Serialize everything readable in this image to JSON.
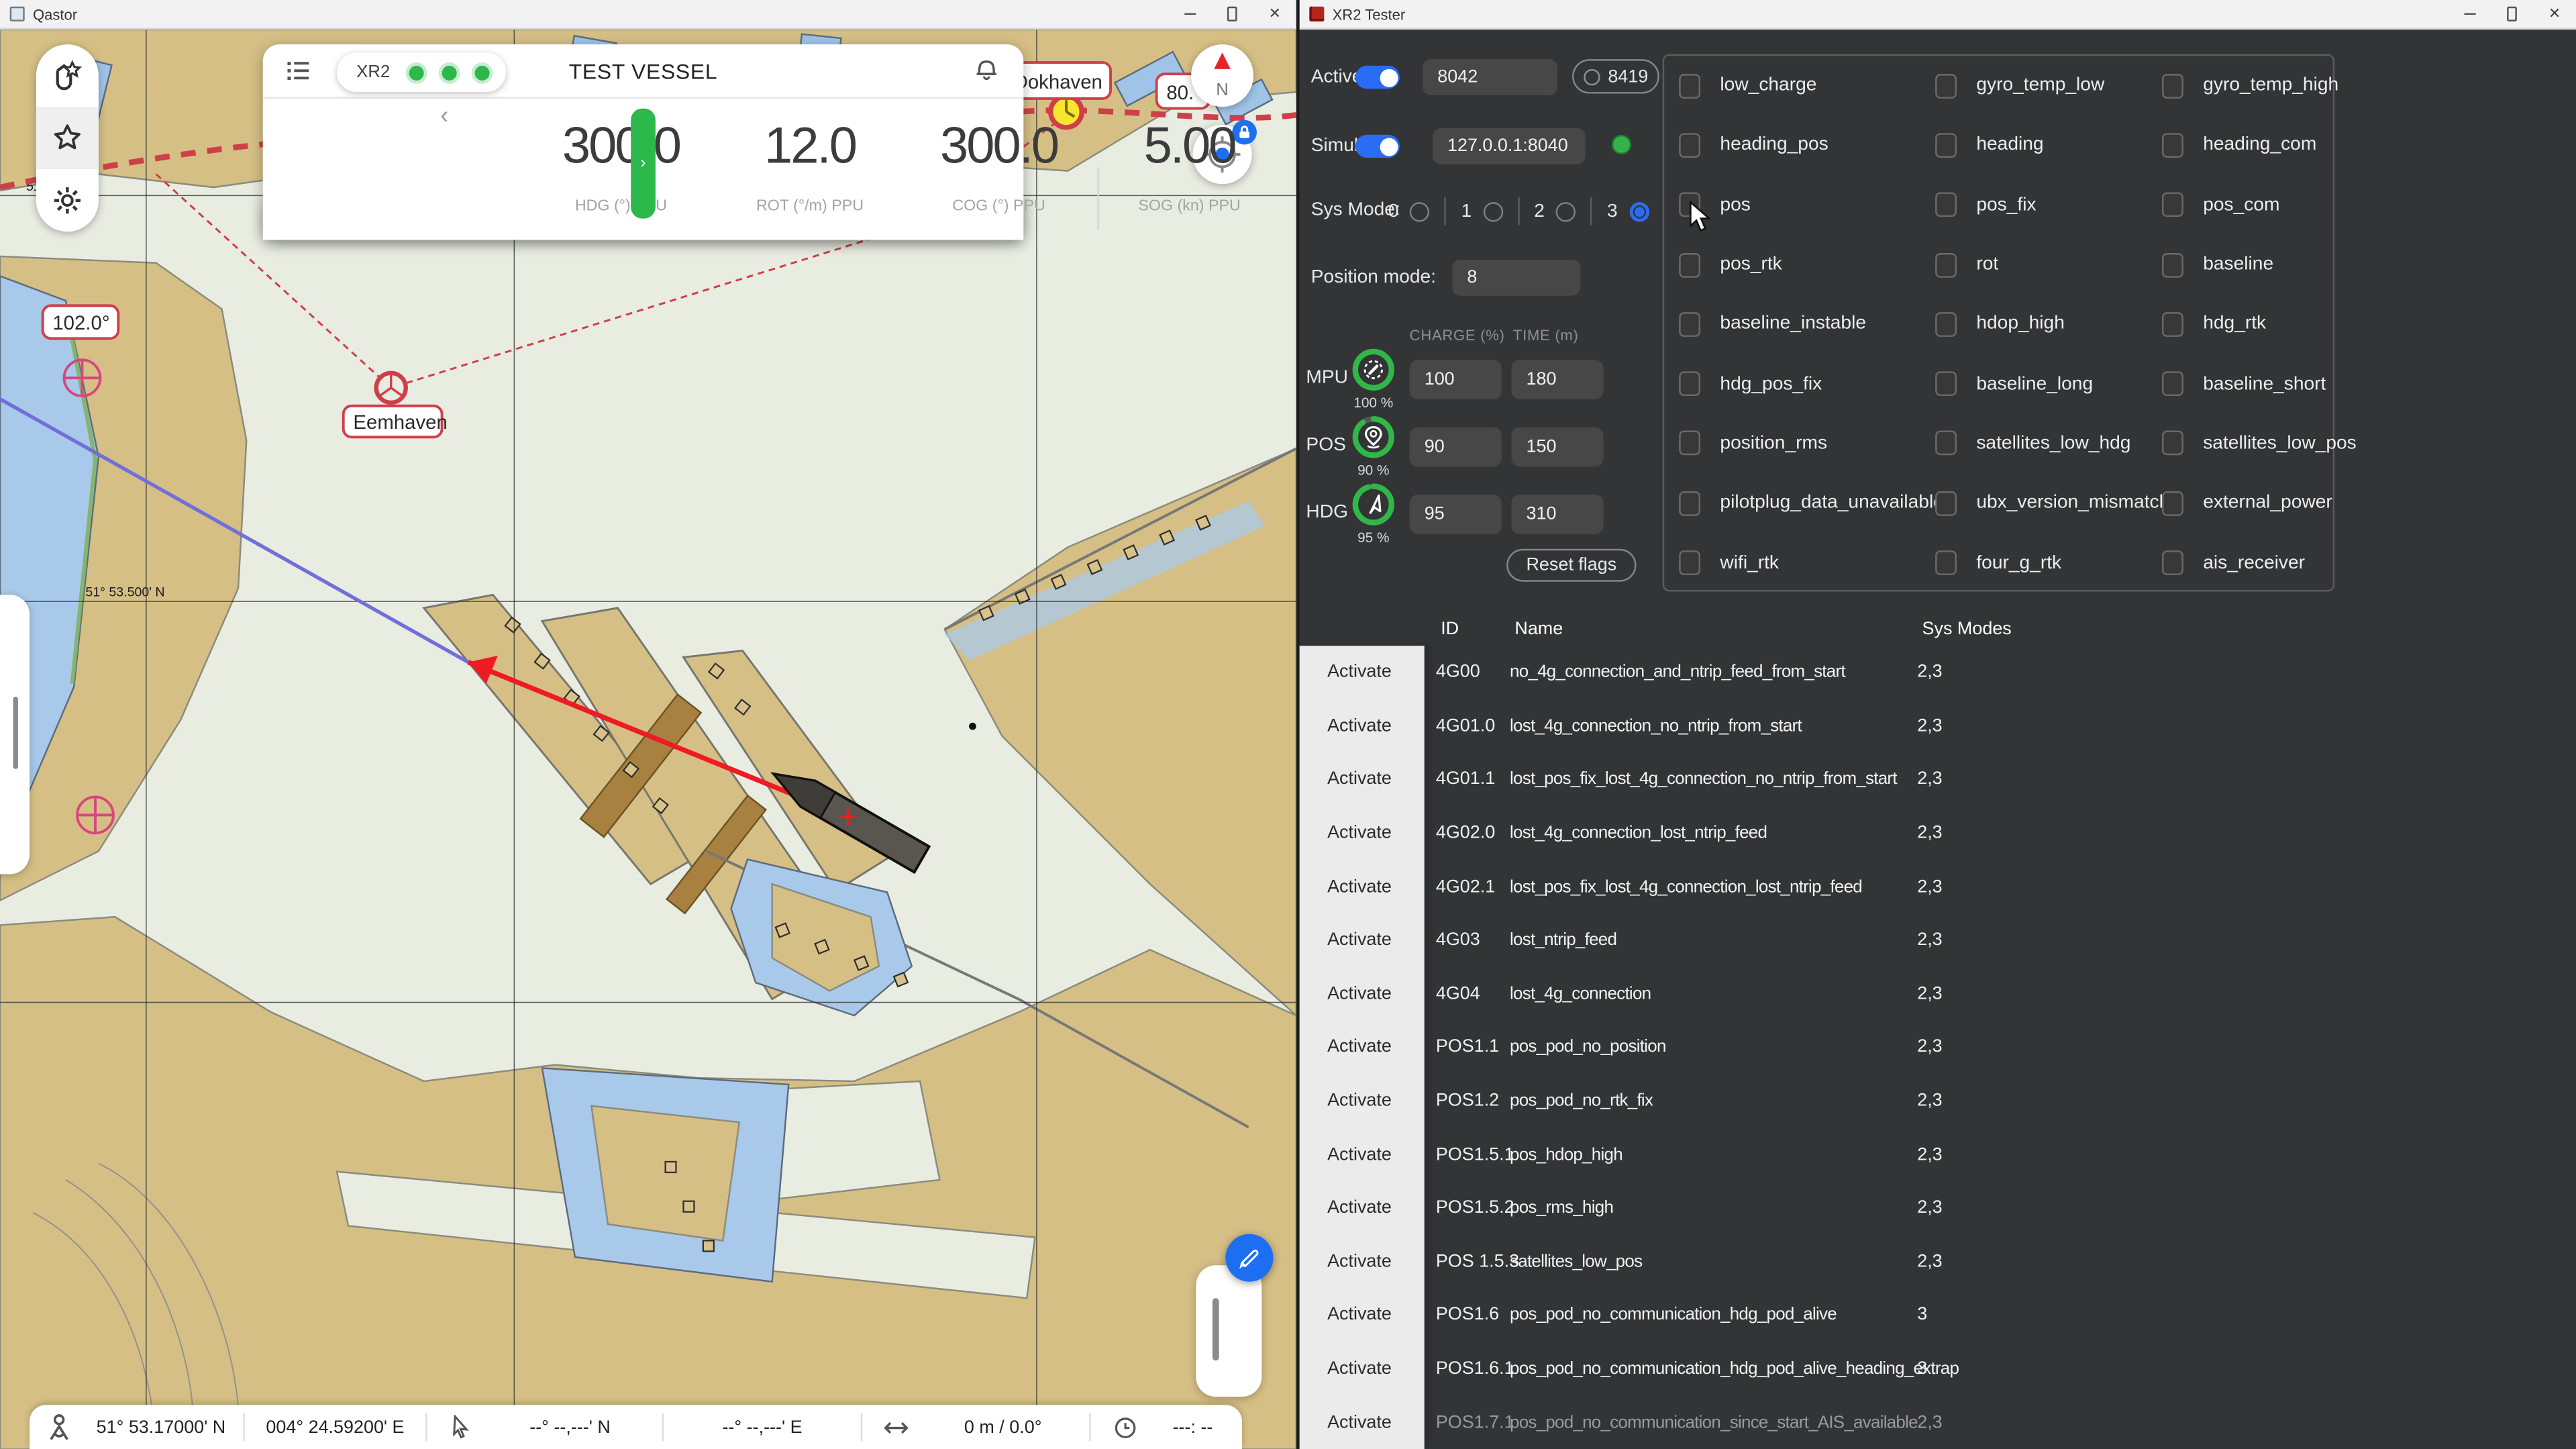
{
  "qastor": {
    "title": "Qastor",
    "vessel_panel": {
      "source_label": "XR2",
      "title": "TEST VESSEL",
      "metrics": [
        {
          "value": "300.0",
          "label": "HDG (°) PPU"
        },
        {
          "value": "12.0",
          "label": "ROT (°/m) PPU"
        },
        {
          "value": "300.0",
          "label": "COG (°) PPU"
        },
        {
          "value": "5.00",
          "label": "SOG (kn) PPU"
        }
      ]
    },
    "map_labels": {
      "course": "102.0°",
      "eemhaven": "Eemhaven",
      "dokhaven": "Dokhaven",
      "turn": "80.",
      "north": "N",
      "lat_line": "51° 53.500' N",
      "lat_small": "51°"
    },
    "status_bar": {
      "own_lat": "51° 53.17000' N",
      "own_lon": "004° 24.59200' E",
      "cursor_lat": "--° --,---' N",
      "cursor_lon": "--° --,---' E",
      "range_bearing": "0 m / 0.0°",
      "eta": "---: --"
    },
    "colors": {
      "route_red": "#cf3f4a",
      "land_tan": "#d5bf85",
      "water": "#e8ece1",
      "heading_red": "#ee1b24",
      "accent_blue": "#1d6ff2",
      "ok_green": "#2db84c"
    }
  },
  "xr2": {
    "title": "XR2 Tester",
    "controls": {
      "active_label": "Active",
      "active_port": "8042",
      "secondary_port": "8419",
      "simulate_label": "Simulate",
      "simulate_address": "127.0.0.1:8040",
      "sys_mode_label": "Sys Mode:",
      "sys_modes": [
        "0",
        "1",
        "2",
        "3"
      ],
      "sys_mode_selected": "3",
      "position_mode_label": "Position mode:",
      "position_mode_value": "8",
      "charge_header": "CHARGE (%)",
      "time_header": "TIME (m)",
      "devices": [
        {
          "label": "MPU",
          "percent": "100 %",
          "charge": "100",
          "time": "180"
        },
        {
          "label": "POS",
          "percent": "90 %",
          "charge": "90",
          "time": "150"
        },
        {
          "label": "HDG",
          "percent": "95 %",
          "charge": "95",
          "time": "310"
        }
      ],
      "reset_button": "Reset flags"
    },
    "flags": [
      "low_charge",
      "gyro_temp_low",
      "gyro_temp_high",
      "heading_pos",
      "heading",
      "heading_com",
      "pos",
      "pos_fix",
      "pos_com",
      "pos_rtk",
      "rot",
      "baseline",
      "baseline_instable",
      "hdop_high",
      "hdg_rtk",
      "hdg_pos_fix",
      "baseline_long",
      "baseline_short",
      "position_rms",
      "satellites_low_hdg",
      "satellites_low_pos",
      "pilotplug_data_unavailable",
      "ubx_version_mismatch",
      "external_power",
      "wifi_rtk",
      "four_g_rtk",
      "ais_receiver"
    ],
    "table": {
      "activate_label": "Activate",
      "headers": [
        "ID",
        "Name",
        "Sys Modes"
      ],
      "rows": [
        {
          "id": "4G00",
          "name": "no_4g_connection_and_ntrip_feed_from_start",
          "sys": "2,3"
        },
        {
          "id": "4G01.0",
          "name": "lost_4g_connection_no_ntrip_from_start",
          "sys": "2,3"
        },
        {
          "id": "4G01.1",
          "name": "lost_pos_fix_lost_4g_connection_no_ntrip_from_start",
          "sys": "2,3"
        },
        {
          "id": "4G02.0",
          "name": "lost_4g_connection_lost_ntrip_feed",
          "sys": "2,3"
        },
        {
          "id": "4G02.1",
          "name": "lost_pos_fix_lost_4g_connection_lost_ntrip_feed",
          "sys": "2,3"
        },
        {
          "id": "4G03",
          "name": "lost_ntrip_feed",
          "sys": "2,3"
        },
        {
          "id": "4G04",
          "name": "lost_4g_connection",
          "sys": "2,3"
        },
        {
          "id": "POS1.1",
          "name": "pos_pod_no_position",
          "sys": "2,3"
        },
        {
          "id": "POS1.2",
          "name": "pos_pod_no_rtk_fix",
          "sys": "2,3"
        },
        {
          "id": "POS1.5.1",
          "name": "pos_hdop_high",
          "sys": "2,3"
        },
        {
          "id": "POS1.5.2",
          "name": "pos_rms_high",
          "sys": "2,3"
        },
        {
          "id": "POS 1.5.3",
          "name": "satellites_low_pos",
          "sys": "2,3"
        },
        {
          "id": "POS1.6",
          "name": "pos_pod_no_communication_hdg_pod_alive",
          "sys": "3"
        },
        {
          "id": "POS1.6.1",
          "name": "pos_pod_no_communication_hdg_pod_alive_heading_extrap",
          "sys": "3"
        },
        {
          "id": "POS1.7.1",
          "name": "pos_pod_no_communication_since_start_AIS_available",
          "sys": "2,3"
        }
      ]
    }
  }
}
